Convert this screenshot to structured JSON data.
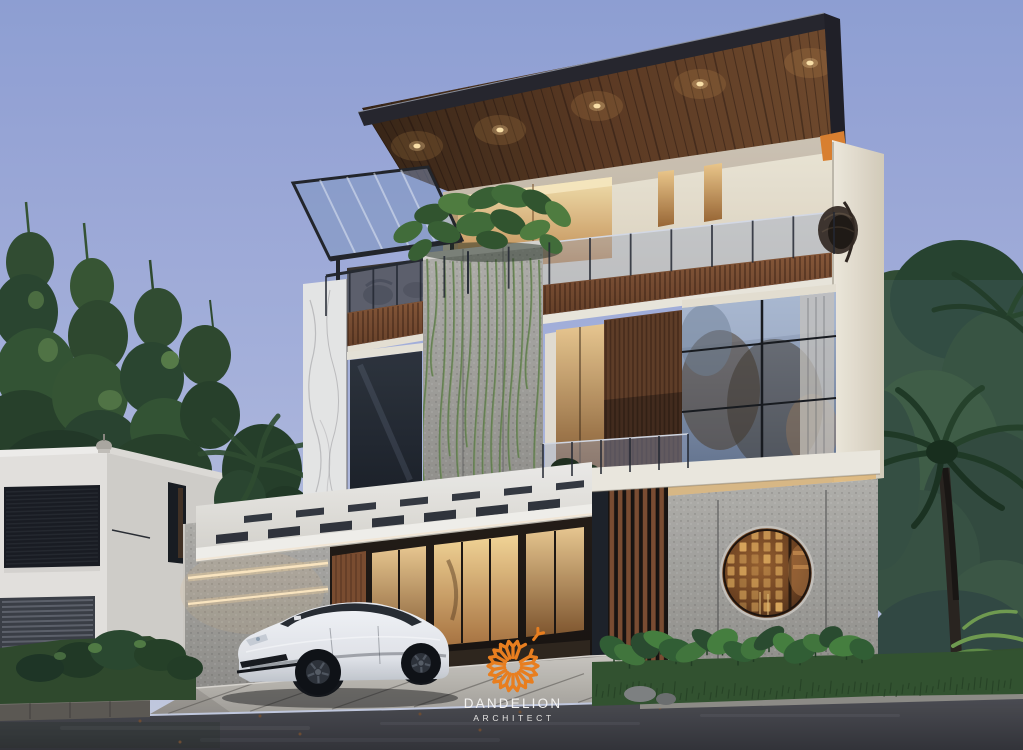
{
  "watermark": {
    "brand": "DANDELION",
    "subtitle": "ARCHITECT",
    "icon": "dandelion-seed-burst-icon",
    "icon_color": "#E87E1F",
    "text_color": "#F3F2F0"
  },
  "palette": {
    "sky_top": "#8F9FD4",
    "sky_bottom": "#C7CDDF",
    "roof_fascia": "#232228",
    "roof_soffit_wood": "#54341E",
    "facade_cream": "#EBE3D0",
    "wood_slats": "#7D4E30",
    "stone_gray": "#A5A39D",
    "marble_white": "#E9E8E6",
    "glass_blue": "#9FAEC8",
    "warm_window_light": "#EFC583",
    "accent_orange": "#DD7F2A",
    "foliage_green": "#2E4A2C",
    "grass_green": "#30502A",
    "asphalt_gray": "#3C3C40",
    "driveway_gray": "#BDB9B1",
    "car_white": "#F0F1F3"
  }
}
